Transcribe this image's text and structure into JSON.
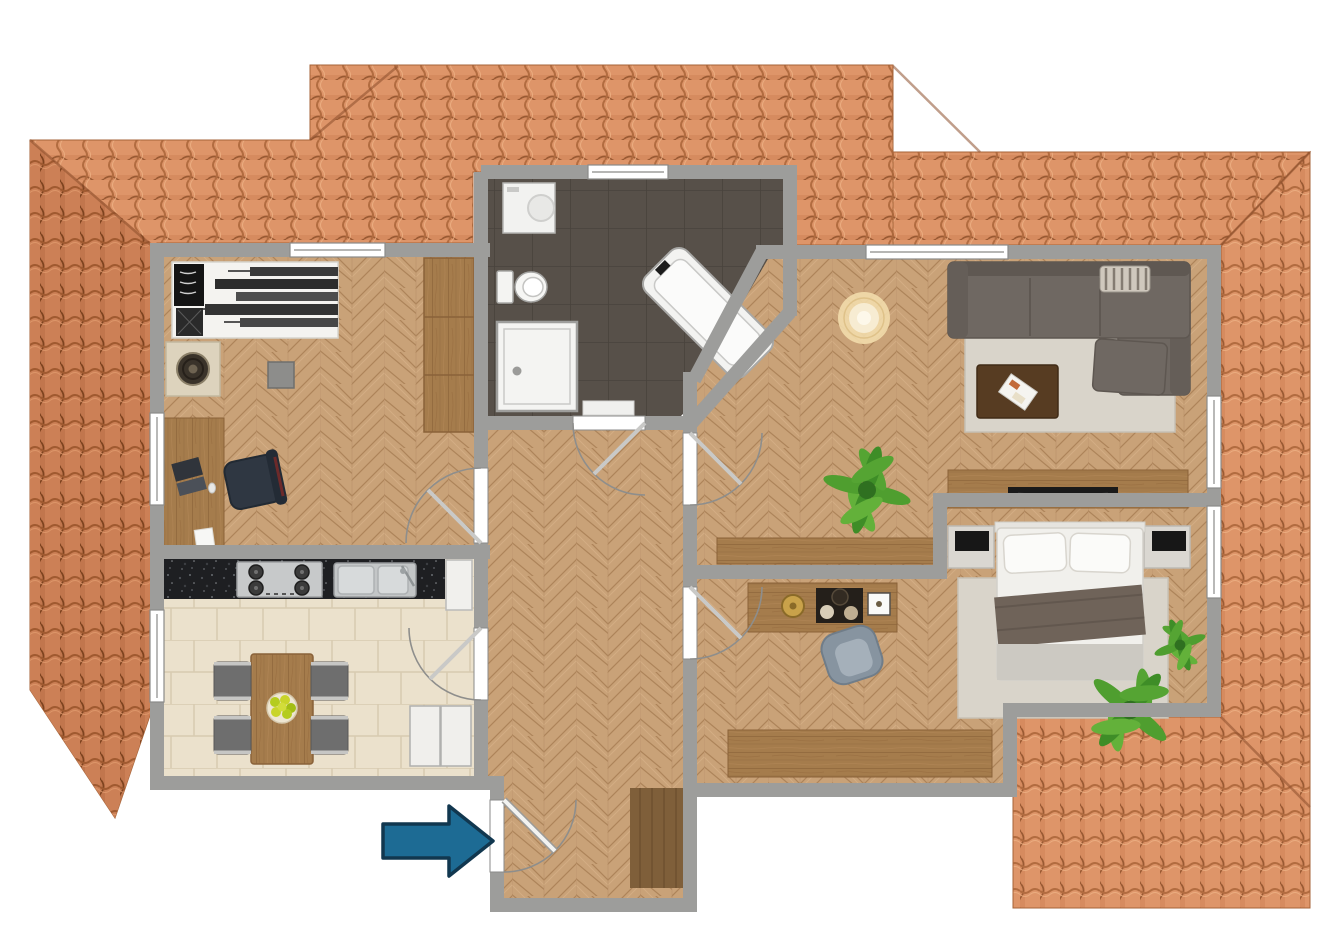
{
  "meta": {
    "kind": "rendered-floor-plan",
    "view": "top-down attic apartment with surrounding tiled roof",
    "visible_text": ""
  },
  "colors": {
    "background": "#ffffff",
    "wall": "#9d9d9b",
    "roof_light": "#de9569",
    "roof_dark": "#cc8056",
    "roof_ridge": "#8d4e2b",
    "parquet": "#c9a278",
    "kitchen_tile": "#ebe1cc",
    "bath_tile": "#575049",
    "furniture_wood": "#a57c4c",
    "counter_granite": "#1e1f22",
    "stainless": "#c7c9ca",
    "sofa": "#6f6862",
    "rug": "#d9d4ca",
    "bed_white": "#f1f0ec",
    "throw_blanket": "#6f6359",
    "nightstand": "#dad7d1",
    "chair_navy": "#2f3742",
    "chair_gray": "#6e6e6e",
    "armchair_gray_blue": "#8794a0",
    "coffee_table": "#573c22",
    "fixture_white": "#f4f4f2",
    "plant_green": "#55a433",
    "lamp_glow": "#f2dcab",
    "entry_mat": "#7f5f3a",
    "arrow_fill": "#1d6b94",
    "arrow_border": "#11374f"
  },
  "rooms": [
    {
      "id": "office",
      "name": "office-kids-room",
      "floor": "herringbone-parquet",
      "furniture": [
        "single-bed-skyline-print",
        "black-pillow",
        "speaker-side-table",
        "wall-stool",
        "wardrobe",
        "desk",
        "laptop",
        "papers",
        "office-chair"
      ]
    },
    {
      "id": "bathroom",
      "name": "bathroom",
      "floor": "dark-tile",
      "furniture": [
        "washing-machine",
        "toilet",
        "shower",
        "bathtub-diagonal",
        "bath-mat"
      ]
    },
    {
      "id": "kitchen",
      "name": "kitchen",
      "floor": "beige-tile",
      "furniture": [
        "granite-counter",
        "gas-stove",
        "double-sink",
        "fridge",
        "dining-table",
        "four-chairs",
        "fruit-bowl",
        "white-base-cabinets"
      ]
    },
    {
      "id": "living",
      "name": "living-room",
      "floor": "herringbone-parquet",
      "furniture": [
        "corner-sofa",
        "striped-cushion",
        "ottoman",
        "area-rug",
        "coffee-table",
        "magazines",
        "floor-lamp",
        "tv-lowboard",
        "tv",
        "low-sideboard",
        "potted-plant"
      ]
    },
    {
      "id": "bedroom",
      "name": "bedroom",
      "floor": "herringbone-parquet",
      "furniture": [
        "double-bed",
        "two-pillows",
        "throw-blanket",
        "nightstand-left",
        "nightstand-right",
        "area-rug",
        "dressing-table",
        "decor-tray",
        "gold-dish",
        "armchair",
        "low-sideboard",
        "palm-plants"
      ]
    },
    {
      "id": "hallway",
      "name": "hallway-entry",
      "floor": "herringbone-parquet",
      "furniture": [
        "entry-mat"
      ]
    }
  ],
  "doors": [
    "entry-door",
    "bathroom-door",
    "kitchen-door",
    "office-door",
    "living-room-door",
    "bedroom-door"
  ],
  "windows_count": 7,
  "annotations": {
    "entrance_arrow": "entrance direction (points right at entry door)"
  }
}
